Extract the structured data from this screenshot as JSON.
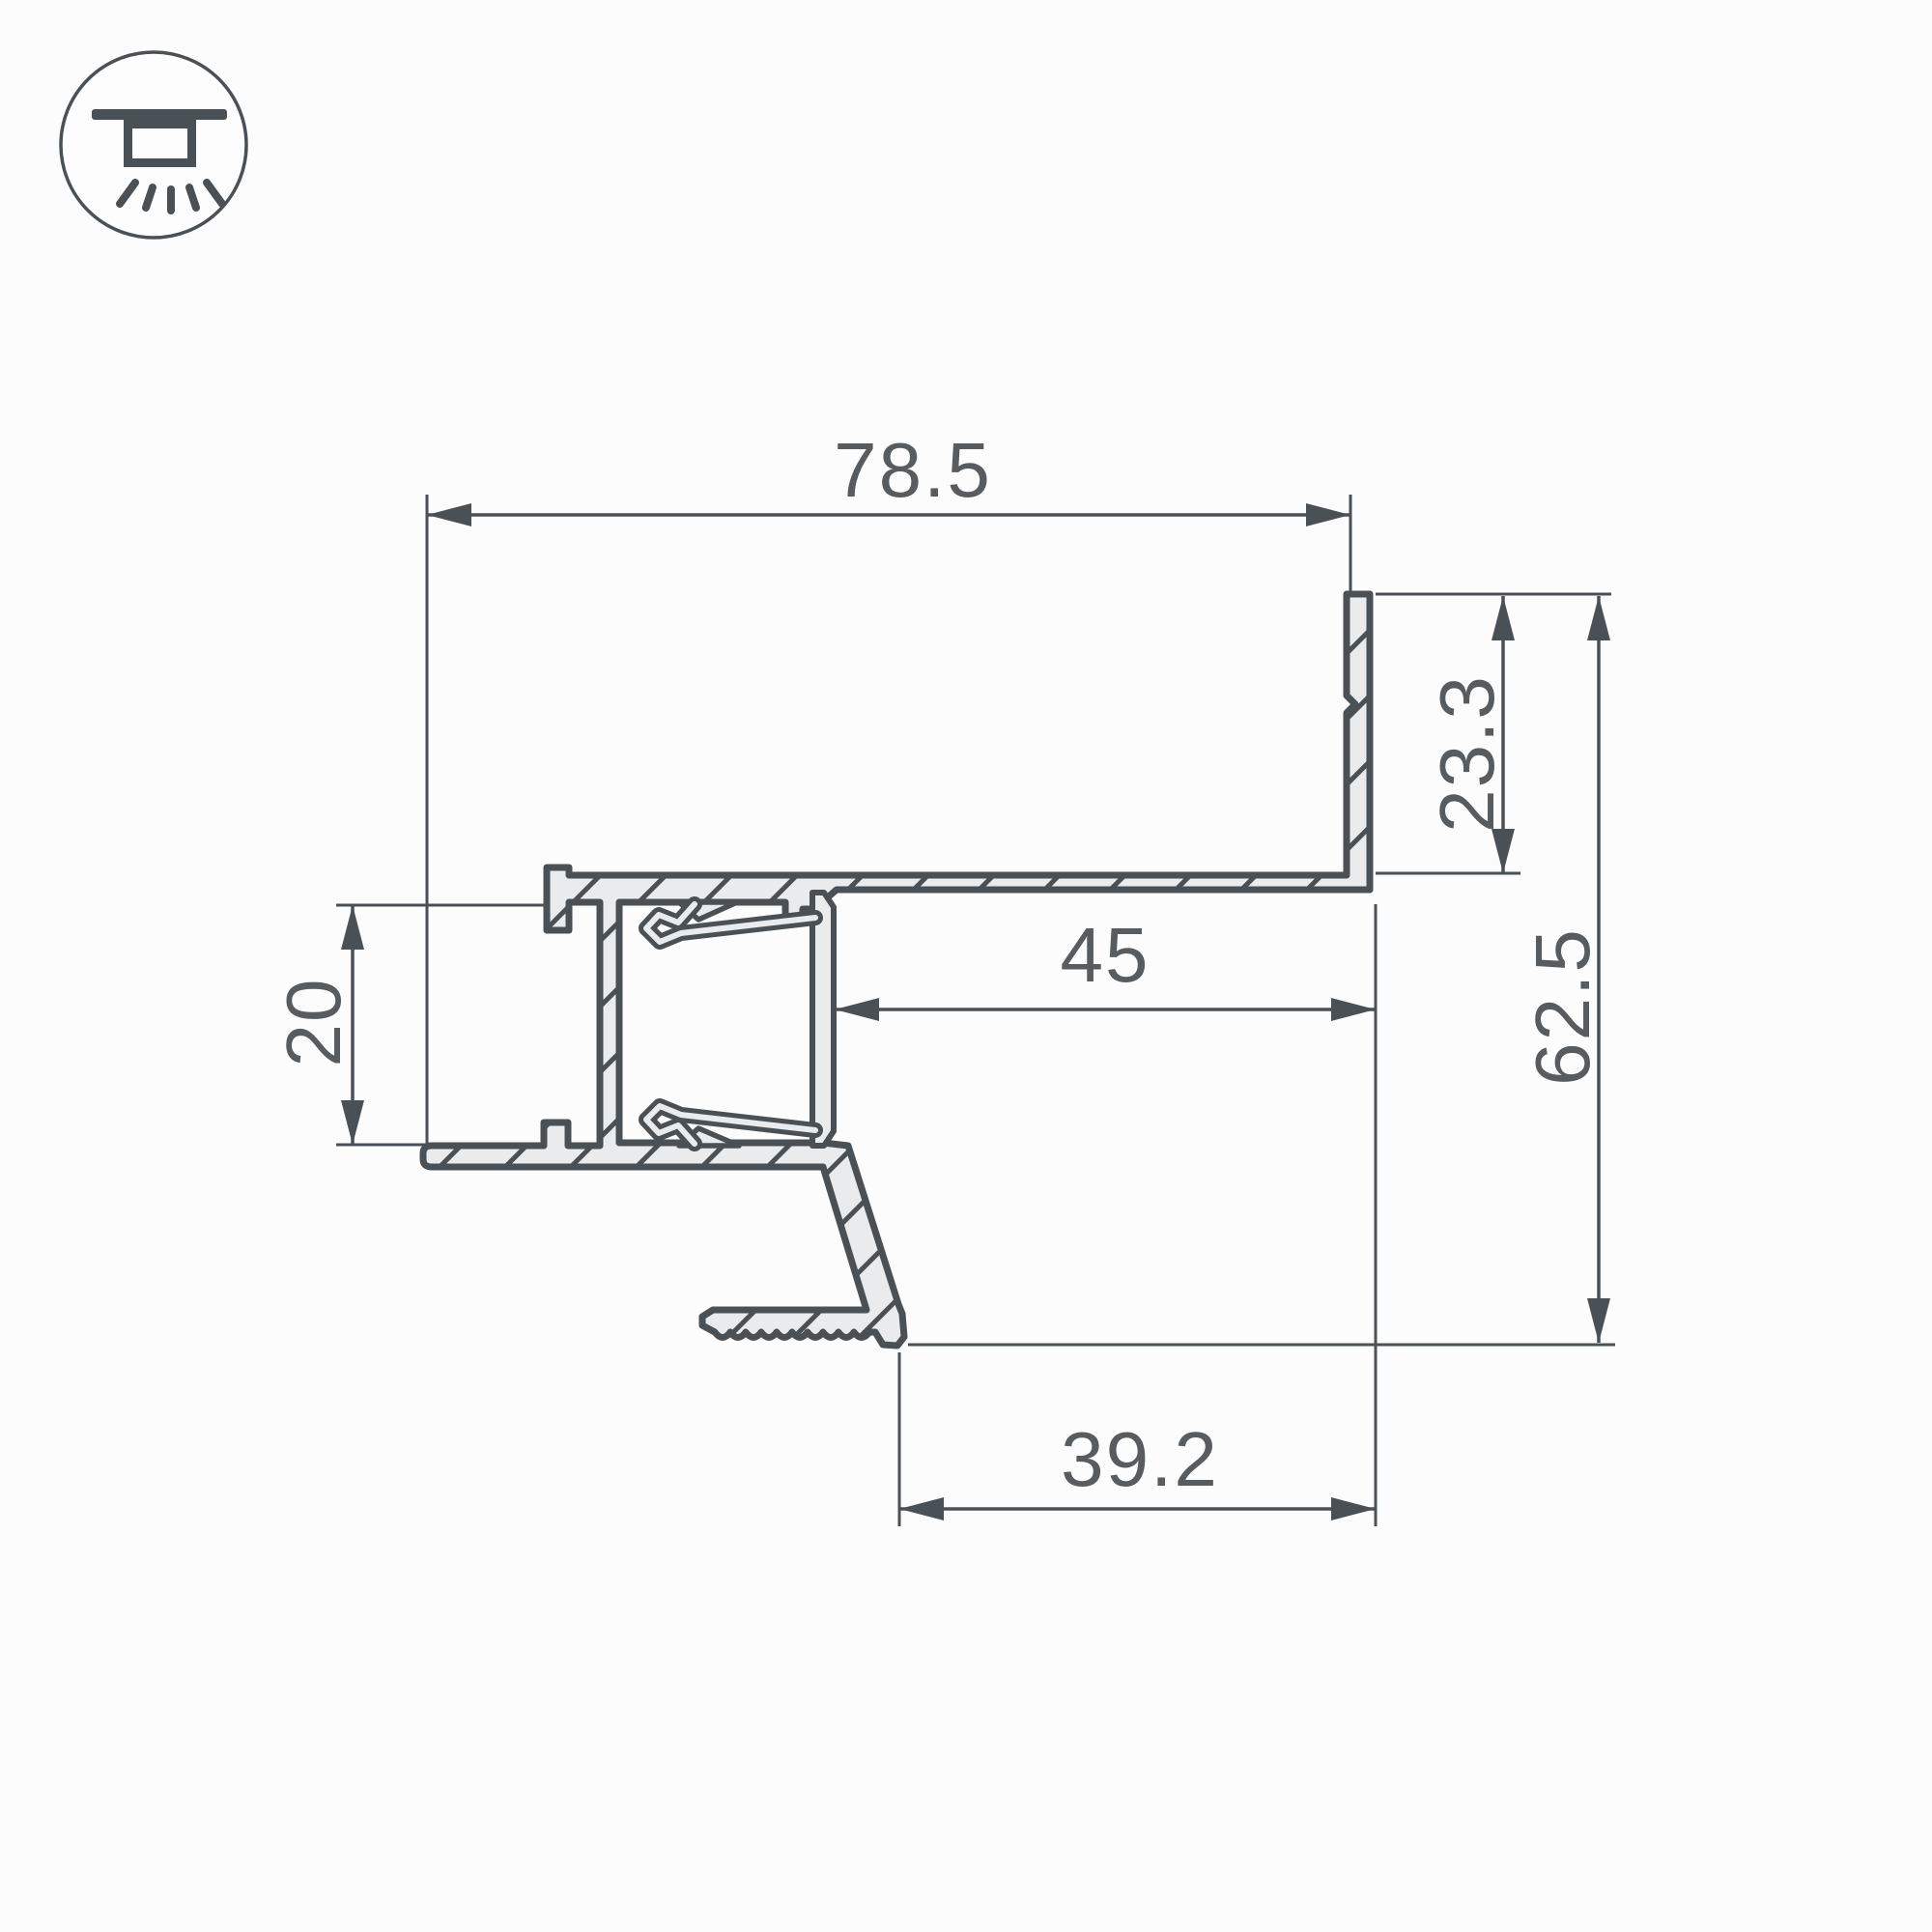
{
  "page": {
    "background": "#fcfcfd",
    "type": "technical-drawing"
  },
  "palette": {
    "line": "#4a5156",
    "text": "#565c60",
    "metal_fill": "#e9ebec"
  },
  "icon": {
    "name": "ceiling-recessed-light-icon"
  },
  "drawing": {
    "subject": "aluminum-led-profile-cross-section"
  },
  "dimensions": {
    "total_width": {
      "value": "78.5"
    },
    "flange_height": {
      "value": "23.3"
    },
    "total_height": {
      "value": "62.5"
    },
    "recess_width": {
      "value": "45"
    },
    "channel_height": {
      "value": "20"
    },
    "base_width": {
      "value": "39.2"
    }
  }
}
